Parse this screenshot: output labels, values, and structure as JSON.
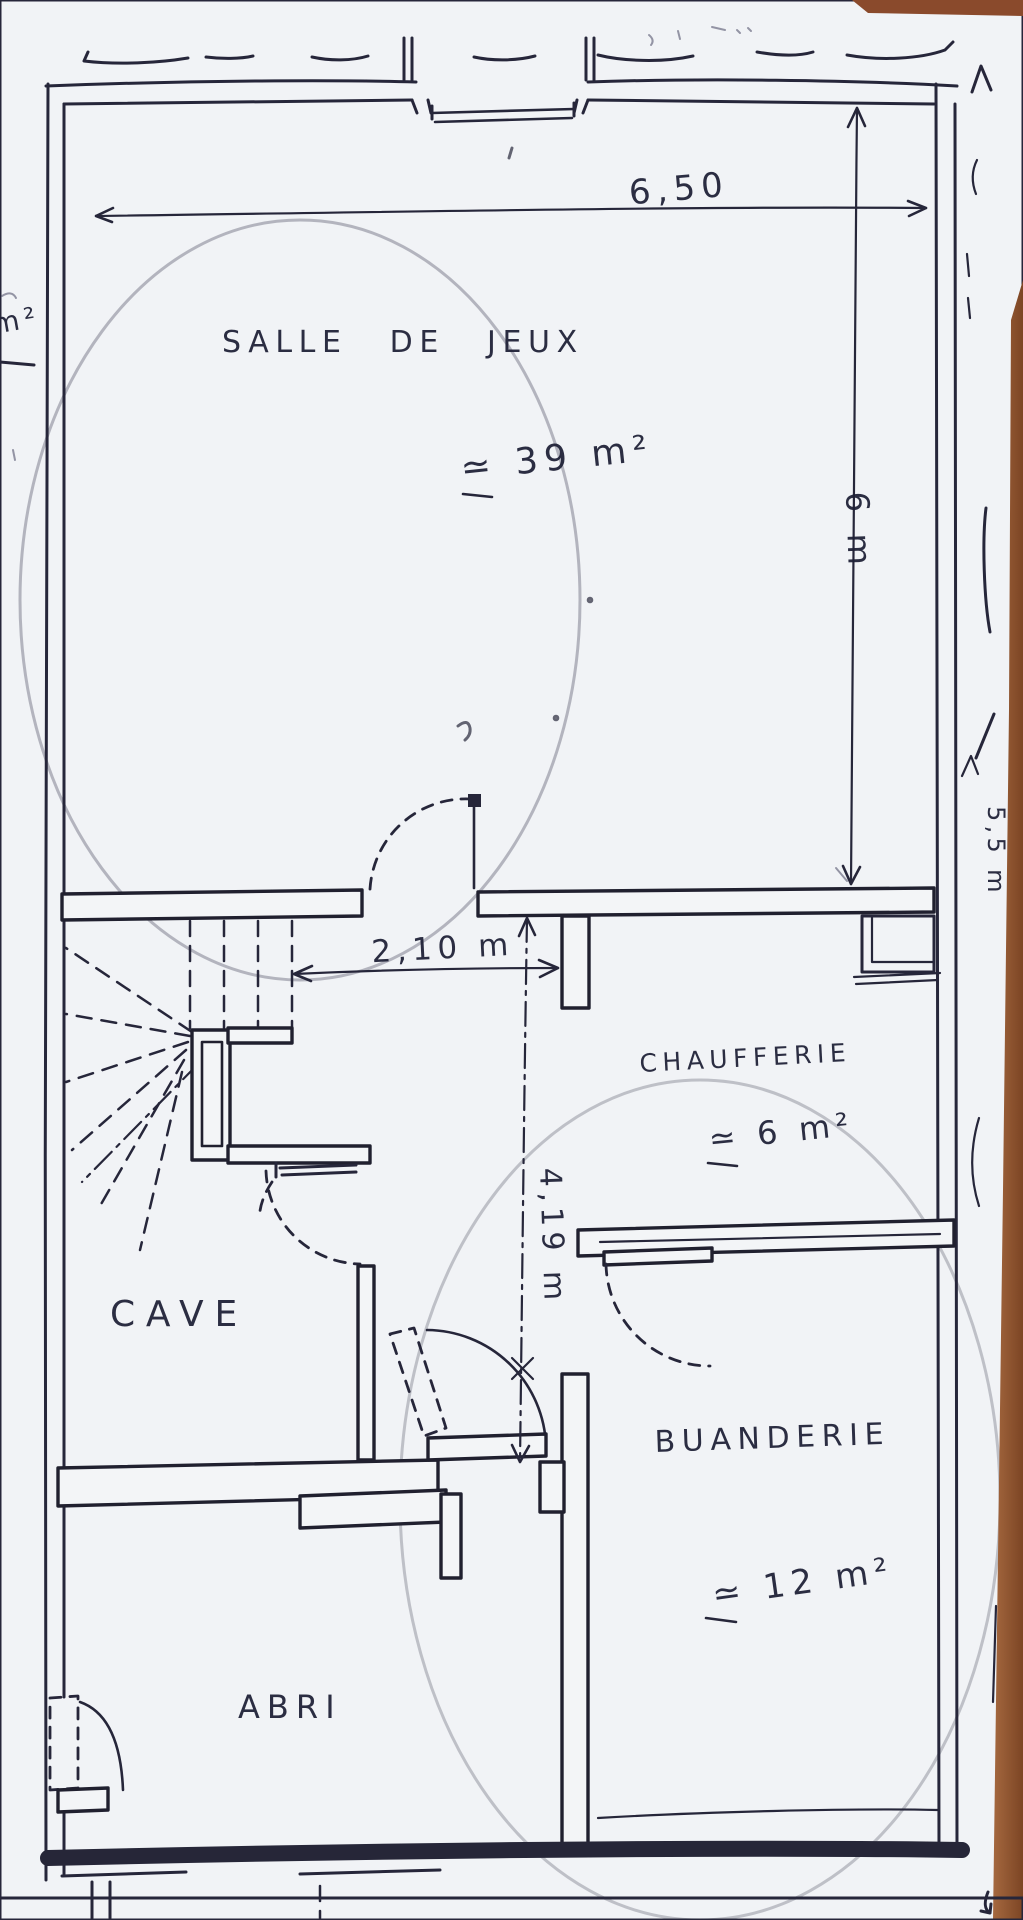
{
  "plan": {
    "rooms": [
      {
        "name": "SALLE DE JEUX",
        "area": "≃ 39 m²"
      },
      {
        "name": "CHAUFFERIE",
        "area": "≃ 6 m²"
      },
      {
        "name": "CAVE",
        "area": ""
      },
      {
        "name": "BUANDERIE",
        "area": "≃ 12 m²"
      },
      {
        "name": "ABRI",
        "area": ""
      }
    ],
    "dimensions": {
      "top_width": "6,50",
      "right_height": "6 m",
      "hall_width": "2,10 m",
      "hall_depth": "4,19 m"
    },
    "edge_notes": {
      "left_fragment": "m²",
      "right_note": "5,5 m"
    },
    "colors": {
      "ink": "#26263a",
      "paper": "#f1f3f6",
      "wood_edge": "#96582f"
    }
  }
}
